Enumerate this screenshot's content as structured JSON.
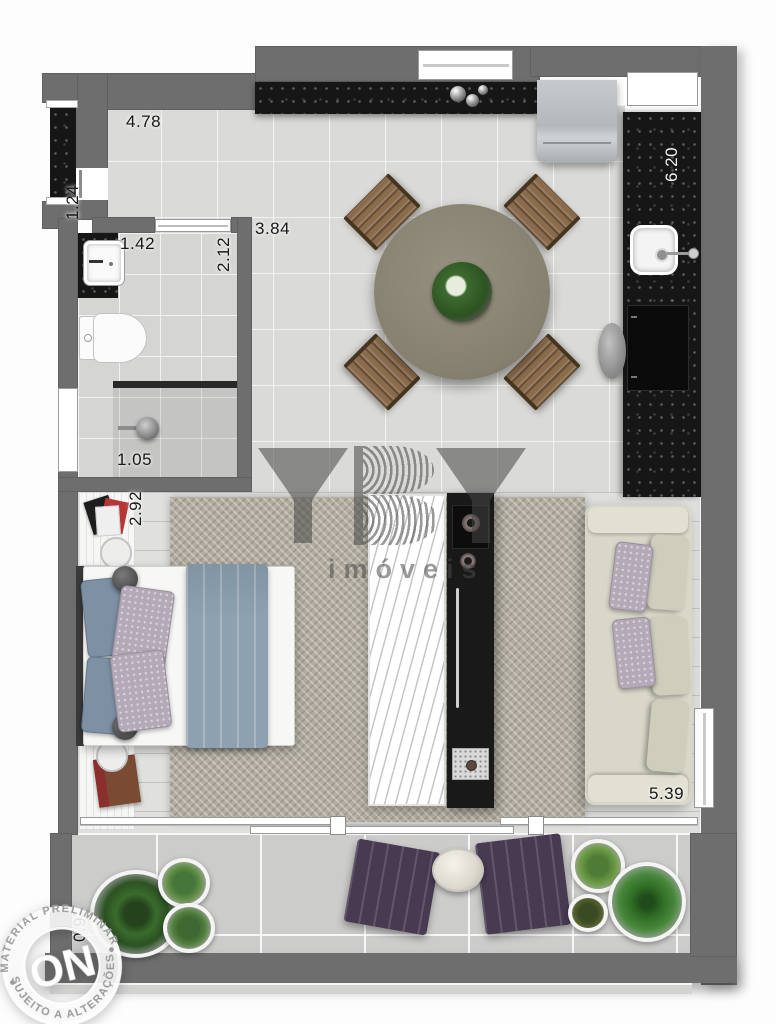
{
  "dimensions": {
    "top_wall": "4.78",
    "entry": "1.24",
    "bathroom_door": "1.42",
    "bathroom_depth": "2.12",
    "living_opening": "3.84",
    "kitchen_wall": "6.20",
    "shower": "1.05",
    "bedroom": "2.92",
    "sofa_wall": "5.39",
    "balcony": "0.97"
  },
  "watermark": {
    "brand_suffix": "imóveis"
  },
  "stamp": {
    "center": "ON",
    "arc_top": "MATERIAL PRELIMINAR",
    "arc_bottom": "SUJEITO A ALTERAÇÕES"
  },
  "palette": {
    "wall": "#6e6e6e",
    "granite": "#161616",
    "tile": "#dadad8",
    "rug": "#b2ada0",
    "sofa": "#d9d7c8",
    "lounger": "#473a51",
    "blanket": "#8da1b1",
    "plant": "#3e7a33"
  }
}
